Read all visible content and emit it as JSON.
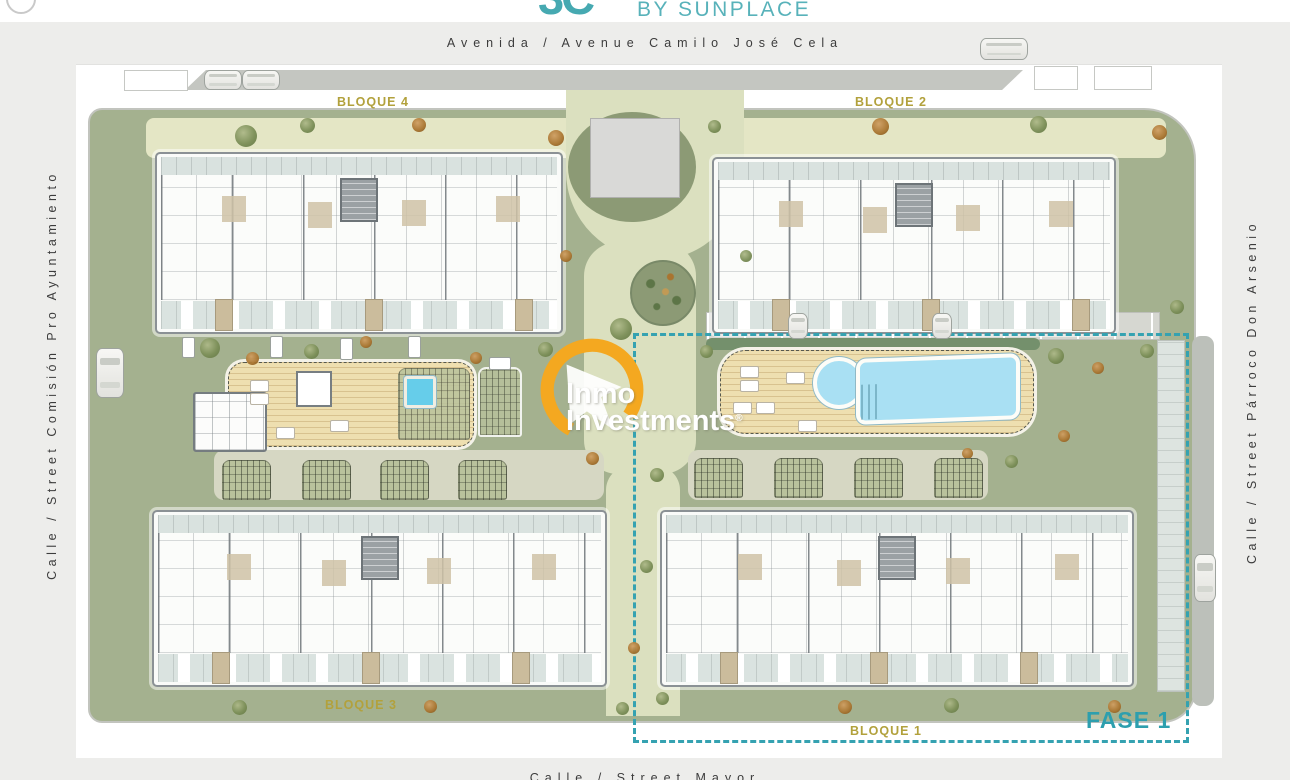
{
  "header": {
    "logo_glyph": "3C",
    "byline": "BY SUNPLACE"
  },
  "streets": {
    "top": "Avenida / Avenue Camilo José Cela",
    "left": "Calle / Street Comisión Pro Ayuntamiento",
    "right": "Calle / Street Párroco Don Arsenio",
    "bottom": "Calle / Street Mayor"
  },
  "blocks": {
    "bloque4": "BLOQUE 4",
    "bloque2": "BLOQUE 2",
    "bloque3": "BLOQUE 3",
    "bloque1": "BLOQUE 1"
  },
  "phase": {
    "label": "FASE 1"
  },
  "watermark": {
    "line1": "Inmo",
    "line2": "Investments",
    "registered": "®"
  },
  "icons": {
    "tree": "tree-icon",
    "car": "car-icon",
    "lounger": "lounger-icon",
    "bench": "bench-icon",
    "watermark_logo": "watermark-house-ring-icon"
  },
  "colors": {
    "accent_teal": "#4aacb2",
    "label_gold": "#b2a13c",
    "phase_teal": "#2d9fae",
    "pool_blue": "#a9e0f3",
    "deck_tan": "#eedfb0",
    "site_green": "#a4b18f",
    "watermark_orange": "#f4a820"
  }
}
